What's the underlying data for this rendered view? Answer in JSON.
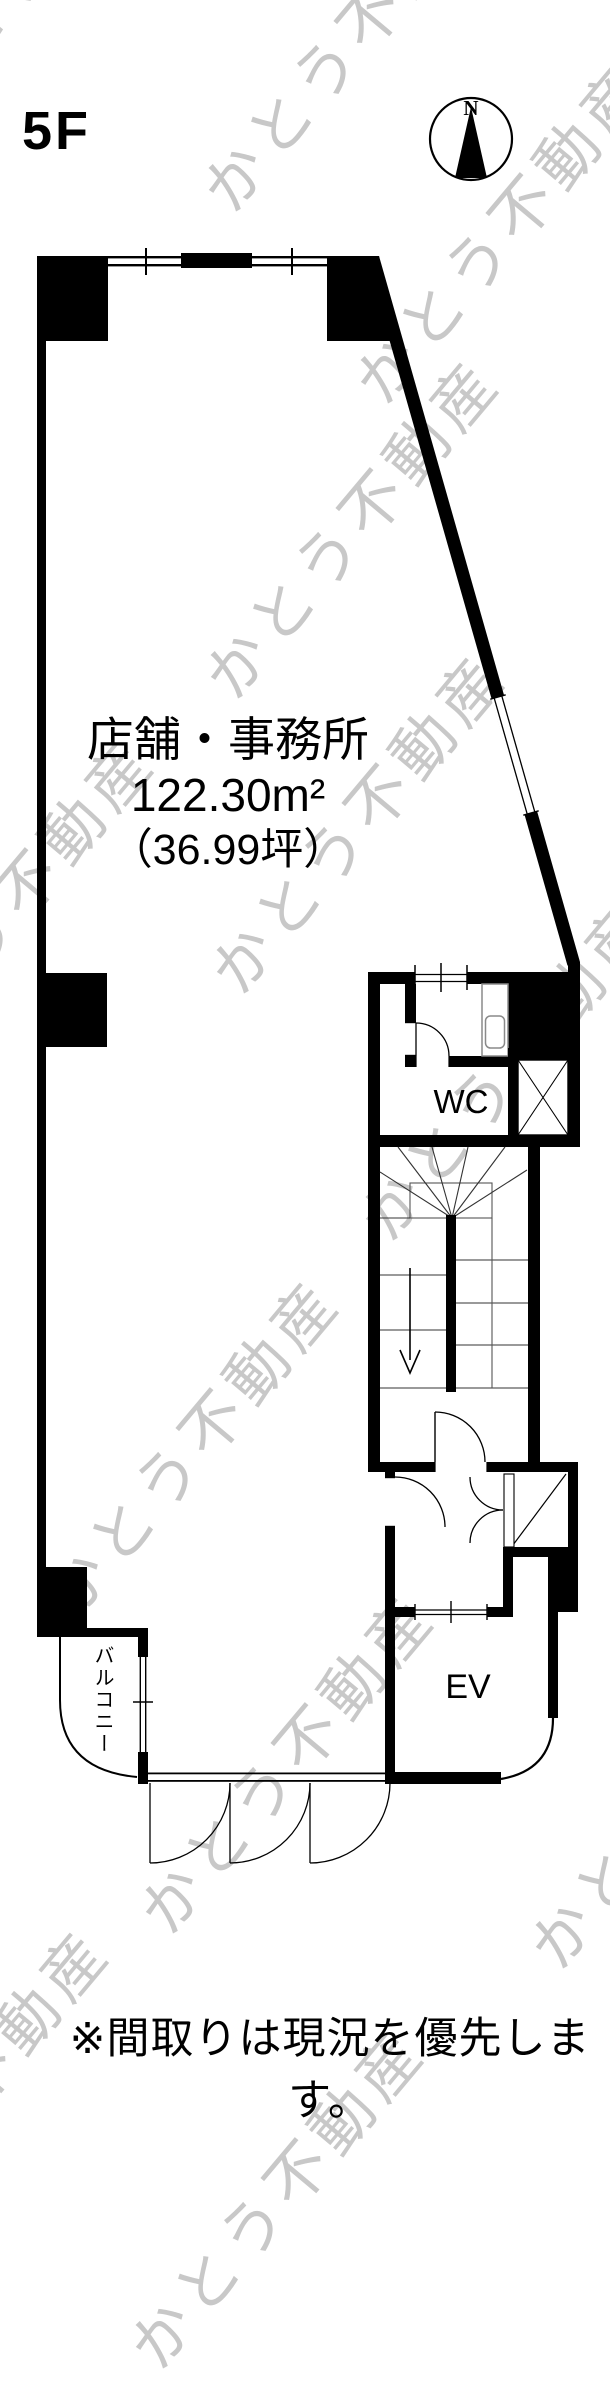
{
  "page": {
    "floor_label": "5F",
    "note": "※間取りは現況を優先します。"
  },
  "compass": {
    "north_label": "N"
  },
  "rooms": {
    "main": {
      "name": "店舗・事務所",
      "area_sqm": "122.30m²",
      "area_tsubo": "（36.99坪）"
    },
    "wc": {
      "label": "WC"
    },
    "elevator": {
      "label": "EV"
    },
    "balcony": {
      "label": "バルコニー"
    }
  },
  "watermark": {
    "text": "かとう不動産",
    "color": "#c8c8c8"
  },
  "colors": {
    "wall": "#000000",
    "background": "#ffffff",
    "watermark": "#c8c8c8"
  }
}
